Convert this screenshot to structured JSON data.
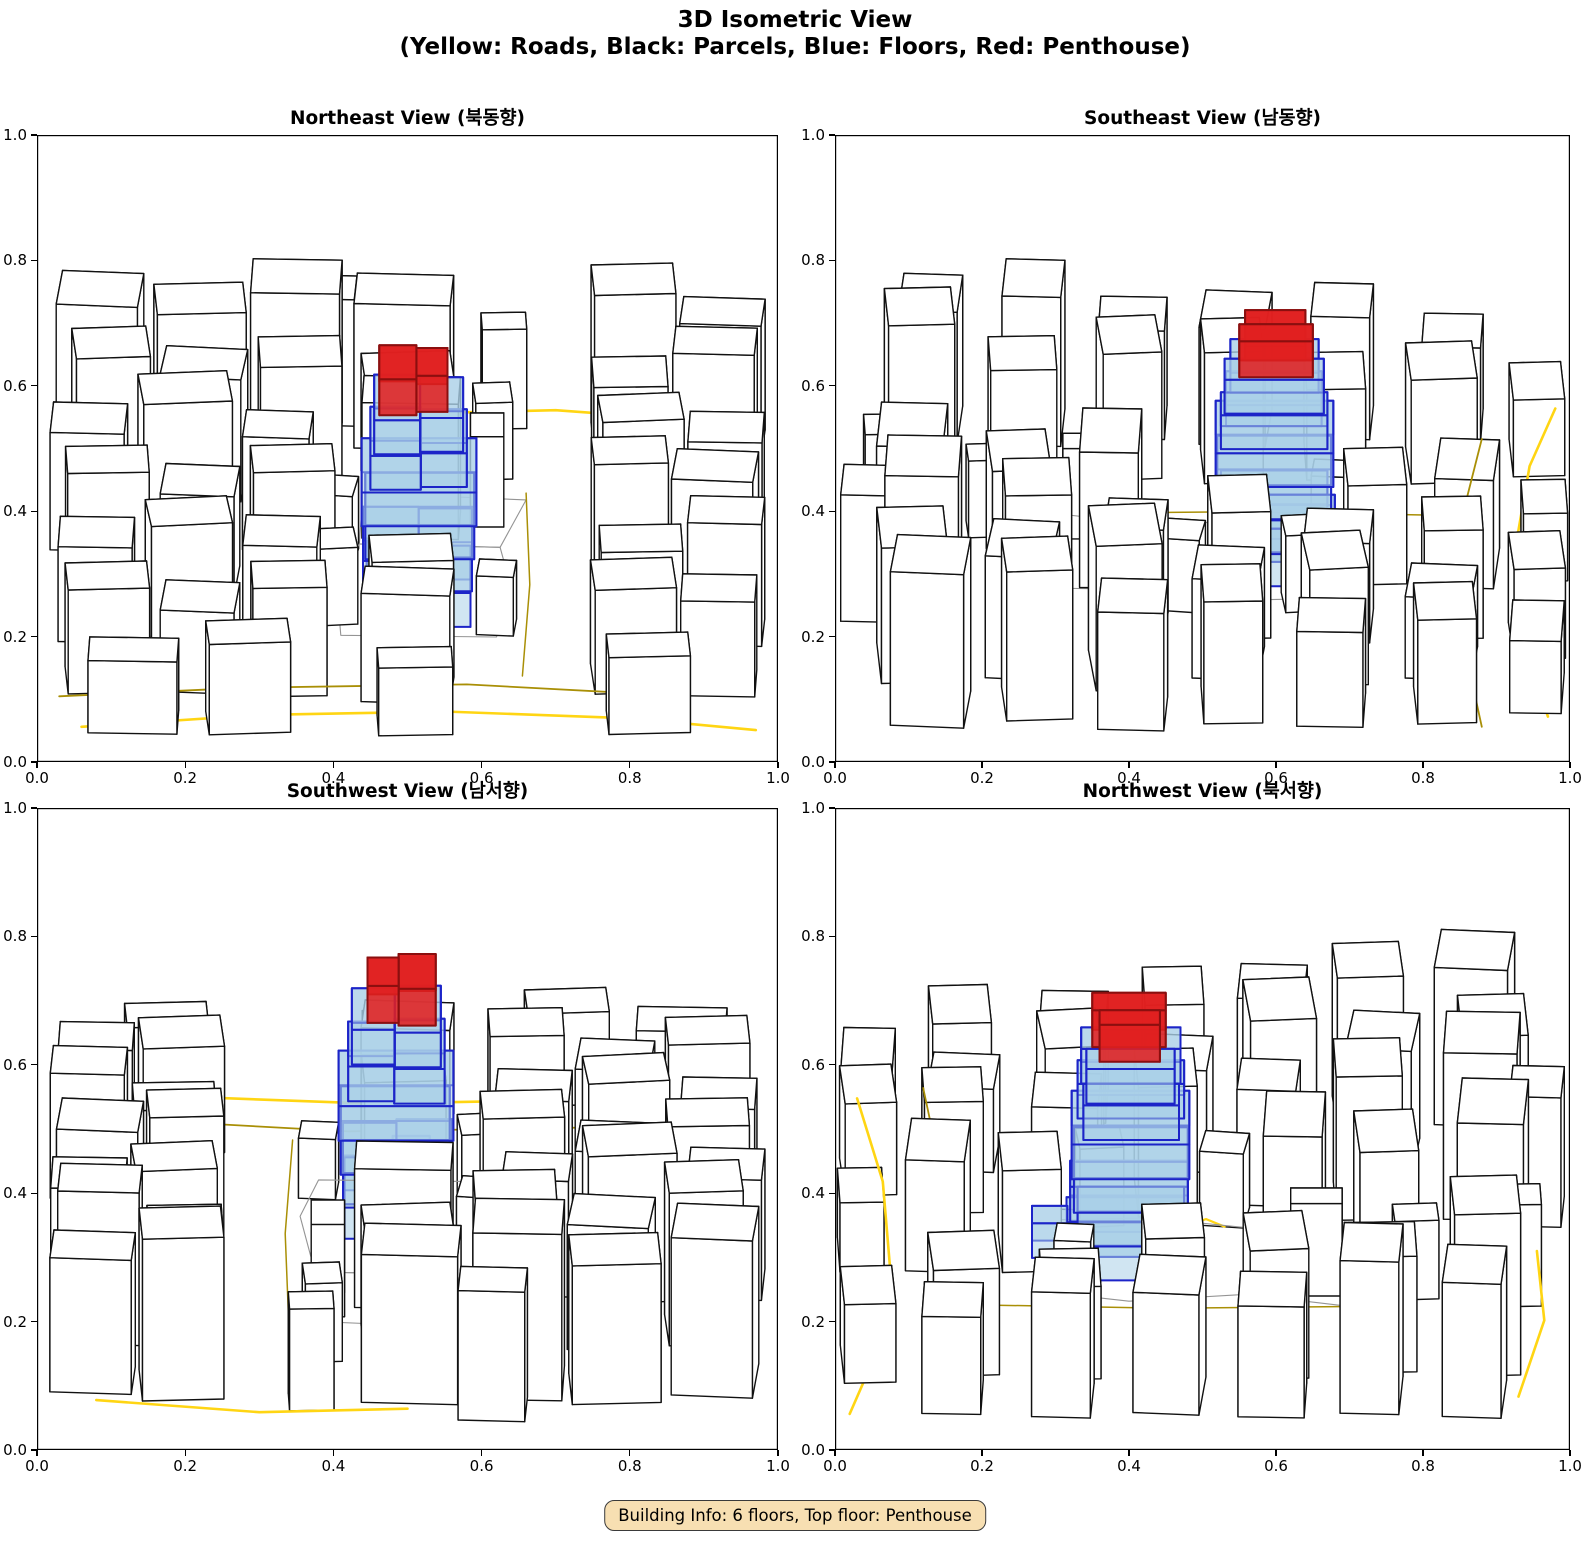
{
  "figure": {
    "title": "3D Isometric View",
    "subtitle": "(Yellow: Roads, Black: Parcels, Blue: Floors, Red: Penthouse)"
  },
  "badge": {
    "text": "Building Info: 6 floors, Top floor: Penthouse",
    "bg": "#f7dfb2",
    "border": "#3a3a3a"
  },
  "axis": {
    "ticks": [
      "0.0",
      "0.2",
      "0.4",
      "0.6",
      "0.8",
      "1.0"
    ],
    "range": [
      0,
      1
    ]
  },
  "colors": {
    "road": "#ffd513",
    "road_dim": "#a98f06",
    "parcel_stroke": "#111111",
    "building_fill": "#ffffff",
    "floor_fill": "#a9cfe7",
    "floor_stroke": "#1c24c8",
    "penthouse_fill": "#e02020",
    "penthouse_stroke": "#8b0f0f",
    "ground_line": "#949494"
  },
  "chart_data": {
    "type": "3d_isometric",
    "title": "3D Isometric View",
    "legend_note": "Yellow: Roads, Black: Parcels, Blue: Floors, Red: Penthouse",
    "building_info": {
      "floors": 6,
      "top_floor": "Penthouse"
    },
    "subplots": [
      {
        "title": "Northeast View (북동향)",
        "azimuth": 0
      },
      {
        "title": "Southeast View (남동향)",
        "azimuth": 90
      },
      {
        "title": "Southwest View (남서향)",
        "azimuth": 180
      },
      {
        "title": "Northwest View (북서향)",
        "azimuth": 270
      }
    ],
    "xlim": [
      0,
      1
    ],
    "ylim": [
      0,
      1
    ],
    "grid": false,
    "city": {
      "buildings": [
        [
          0.03,
          0.82,
          0.11,
          0.1,
          0.34,
          -5
        ],
        [
          0.16,
          0.85,
          0.12,
          0.09,
          0.3,
          3
        ],
        [
          0.29,
          0.83,
          0.12,
          0.1,
          0.36,
          -2
        ],
        [
          0.34,
          0.92,
          0.09,
          0.07,
          0.28,
          -3
        ],
        [
          0.05,
          0.68,
          0.1,
          0.09,
          0.33,
          4
        ],
        [
          0.17,
          0.7,
          0.11,
          0.09,
          0.27,
          -6
        ],
        [
          0.3,
          0.68,
          0.11,
          0.09,
          0.31,
          2
        ],
        [
          0.02,
          0.55,
          0.1,
          0.09,
          0.26,
          -3
        ],
        [
          0.14,
          0.56,
          0.12,
          0.09,
          0.32,
          5
        ],
        [
          0.28,
          0.55,
          0.09,
          0.08,
          0.25,
          -4
        ],
        [
          0.04,
          0.42,
          0.11,
          0.08,
          0.27,
          2
        ],
        [
          0.17,
          0.42,
          0.1,
          0.09,
          0.22,
          -5
        ],
        [
          0.29,
          0.41,
          0.11,
          0.08,
          0.28,
          3
        ],
        [
          0.37,
          0.5,
          0.06,
          0.06,
          0.16,
          -8
        ],
        [
          0.37,
          0.33,
          0.06,
          0.06,
          0.17,
          6
        ],
        [
          0.03,
          0.28,
          0.1,
          0.09,
          0.21,
          -2
        ],
        [
          0.15,
          0.28,
          0.11,
          0.08,
          0.26,
          6
        ],
        [
          0.28,
          0.27,
          0.1,
          0.09,
          0.22,
          -3
        ],
        [
          0.04,
          0.13,
          0.11,
          0.08,
          0.23,
          3
        ],
        [
          0.17,
          0.13,
          0.1,
          0.09,
          0.18,
          -5
        ],
        [
          0.29,
          0.12,
          0.1,
          0.08,
          0.24,
          2
        ],
        [
          0.07,
          0.01,
          0.12,
          0.07,
          0.16,
          -2
        ],
        [
          0.23,
          0.01,
          0.11,
          0.07,
          0.2,
          4
        ],
        [
          0.43,
          0.85,
          0.13,
          0.09,
          0.32,
          -3
        ],
        [
          0.44,
          0.71,
          0.12,
          0.08,
          0.26,
          4
        ],
        [
          0.44,
          0.585,
          0.13,
          0.08,
          0.3,
          -2
        ],
        [
          0.585,
          0.62,
          0.045,
          0.07,
          0.2,
          0
        ],
        [
          0.59,
          0.76,
          0.05,
          0.06,
          0.17,
          4
        ],
        [
          0.45,
          0.225,
          0.11,
          0.08,
          0.22,
          3
        ],
        [
          0.44,
          0.1,
          0.12,
          0.08,
          0.24,
          -4
        ],
        [
          0.46,
          0.005,
          0.1,
          0.06,
          0.15,
          2
        ],
        [
          0.595,
          0.3,
          0.05,
          0.05,
          0.13,
          -5
        ],
        [
          0.6,
          0.91,
          0.06,
          0.05,
          0.22,
          2
        ],
        [
          0.75,
          0.84,
          0.11,
          0.09,
          0.35,
          3
        ],
        [
          0.87,
          0.83,
          0.11,
          0.08,
          0.29,
          -4
        ],
        [
          0.75,
          0.7,
          0.1,
          0.09,
          0.25,
          2
        ],
        [
          0.86,
          0.69,
          0.11,
          0.08,
          0.33,
          -3
        ],
        [
          0.76,
          0.56,
          0.11,
          0.08,
          0.28,
          5
        ],
        [
          0.88,
          0.55,
          0.1,
          0.09,
          0.24,
          -2
        ],
        [
          0.75,
          0.42,
          0.1,
          0.08,
          0.29,
          3
        ],
        [
          0.86,
          0.41,
          0.11,
          0.09,
          0.26,
          -5
        ],
        [
          0.76,
          0.28,
          0.11,
          0.08,
          0.2,
          2
        ],
        [
          0.88,
          0.27,
          0.1,
          0.08,
          0.27,
          -3
        ],
        [
          0.75,
          0.13,
          0.11,
          0.09,
          0.23,
          4
        ],
        [
          0.87,
          0.12,
          0.1,
          0.08,
          0.21,
          -2
        ],
        [
          0.77,
          0.01,
          0.11,
          0.07,
          0.17,
          3
        ]
      ],
      "central": {
        "floor_height": 0.075,
        "floors": [
          [
            [
              0.445,
              0.315,
              0.072,
              0.16
            ],
            [
              0.517,
              0.325,
              0.068,
              0.14
            ],
            [
              0.47,
              0.268,
              0.05,
              0.048
            ]
          ],
          [
            [
              0.44,
              0.32,
              0.075,
              0.16
            ],
            [
              0.515,
              0.33,
              0.072,
              0.145
            ]
          ],
          [
            [
              0.443,
              0.325,
              0.147,
              0.155
            ]
          ],
          [
            [
              0.438,
              0.322,
              0.155,
              0.16
            ]
          ],
          [
            [
              0.45,
              0.33,
              0.068,
              0.145
            ],
            [
              0.518,
              0.338,
              0.062,
              0.13
            ]
          ],
          [
            [
              0.455,
              0.335,
              0.062,
              0.135
            ],
            [
              0.517,
              0.342,
              0.058,
              0.12
            ]
          ]
        ],
        "penthouse": {
          "boxes": [
            [
              0.462,
              0.35,
              0.05,
              0.1
            ],
            [
              0.512,
              0.36,
              0.042,
              0.082
            ]
          ],
          "height": 0.08
        }
      },
      "roads": [
        {
          "pts": [
            [
              0.06,
              0.03
            ],
            [
              0.3,
              0.065
            ],
            [
              0.55,
              0.075
            ],
            [
              0.8,
              0.055
            ],
            [
              0.97,
              0.02
            ]
          ],
          "color": "road",
          "width": 2.6
        },
        {
          "pts": [
            [
              0.03,
              0.12
            ],
            [
              0.28,
              0.145
            ],
            [
              0.58,
              0.155
            ],
            [
              0.88,
              0.12
            ]
          ],
          "color": "road_dim",
          "width": 1.8
        },
        {
          "pts": [
            [
              0.5,
              0.955
            ],
            [
              0.7,
              0.965
            ],
            [
              0.92,
              0.93
            ]
          ],
          "color": "road",
          "width": 2.6
        },
        {
          "pts": [
            [
              0.655,
              0.18
            ],
            [
              0.665,
              0.45
            ],
            [
              0.66,
              0.72
            ]
          ],
          "color": "road_dim",
          "width": 1.5
        },
        {
          "pts": [
            [
              0.405,
              0.44
            ],
            [
              0.428,
              0.475
            ],
            [
              0.408,
              0.505
            ],
            [
              0.43,
              0.53
            ]
          ],
          "color": "road",
          "width": 2.2
        }
      ],
      "ground_parcels": [
        {
          "pts": [
            [
              0.41,
              0.3
            ],
            [
              0.62,
              0.295
            ],
            [
              0.645,
              0.4
            ],
            [
              0.625,
              0.56
            ],
            [
              0.435,
              0.57
            ],
            [
              0.405,
              0.43
            ]
          ]
        },
        {
          "pts": [
            [
              0.435,
              0.57
            ],
            [
              0.625,
              0.56
            ],
            [
              0.66,
              0.7
            ],
            [
              0.44,
              0.72
            ]
          ]
        }
      ]
    }
  }
}
